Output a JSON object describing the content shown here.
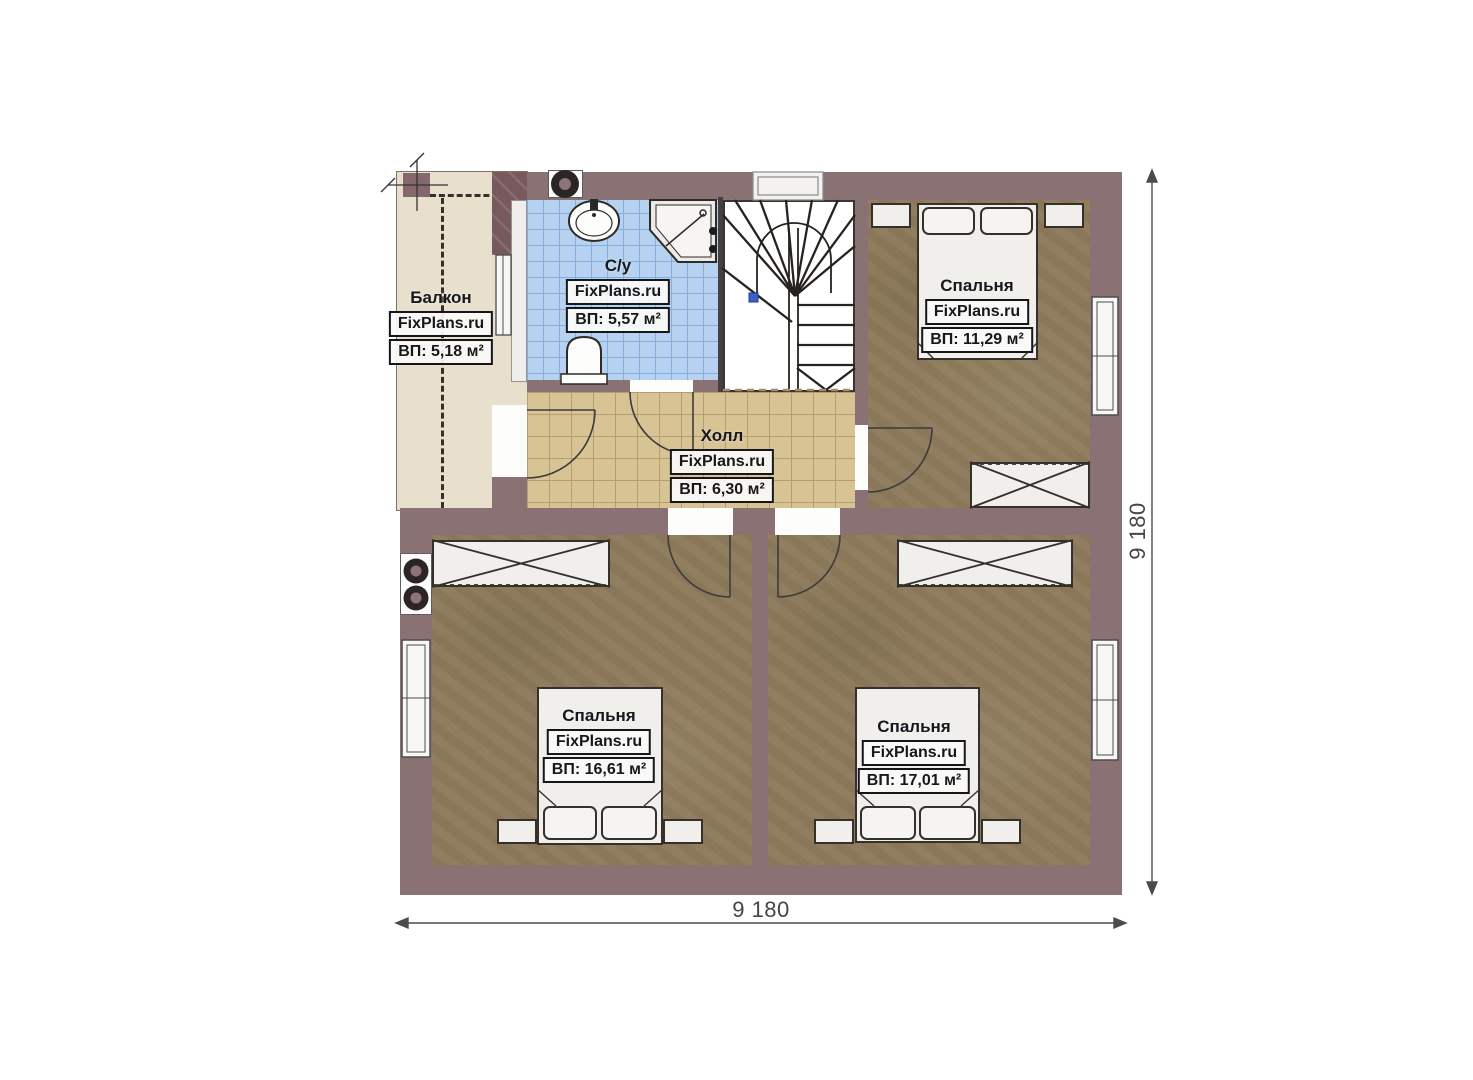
{
  "rooms": {
    "balcony": {
      "name": "Балкон",
      "brand": "FixPlans.ru",
      "area": "ВП: 5,18 м²"
    },
    "bathroom": {
      "name": "С/у",
      "brand": "FixPlans.ru",
      "area": "ВП: 5,57 м²"
    },
    "hall": {
      "name": "Холл",
      "brand": "FixPlans.ru",
      "area": "ВП: 6,30 м²"
    },
    "bedroom_top_right": {
      "name": "Спальня",
      "brand": "FixPlans.ru",
      "area": "ВП: 11,29 м²"
    },
    "bedroom_bottom_left": {
      "name": "Спальня",
      "brand": "FixPlans.ru",
      "area": "ВП: 16,61 м²"
    },
    "bedroom_bottom_right": {
      "name": "Спальня",
      "brand": "FixPlans.ru",
      "area": "ВП: 17,01 м²"
    }
  },
  "dimensions": {
    "width": "9 180",
    "height": "9 180"
  },
  "colors": {
    "wall": "#8a7274",
    "chimney_wall": "#77595e",
    "balcony_floor": "#e8e0cc",
    "bathroom_tile": "#b7d2f0",
    "hall_tile": "#d8c395",
    "bedroom_floor": "#8e7b5c",
    "furniture": "#f0efec",
    "label_border": "#14161a",
    "stair_marker_blue": "#3a62c4",
    "dimension_text": "#454545"
  }
}
